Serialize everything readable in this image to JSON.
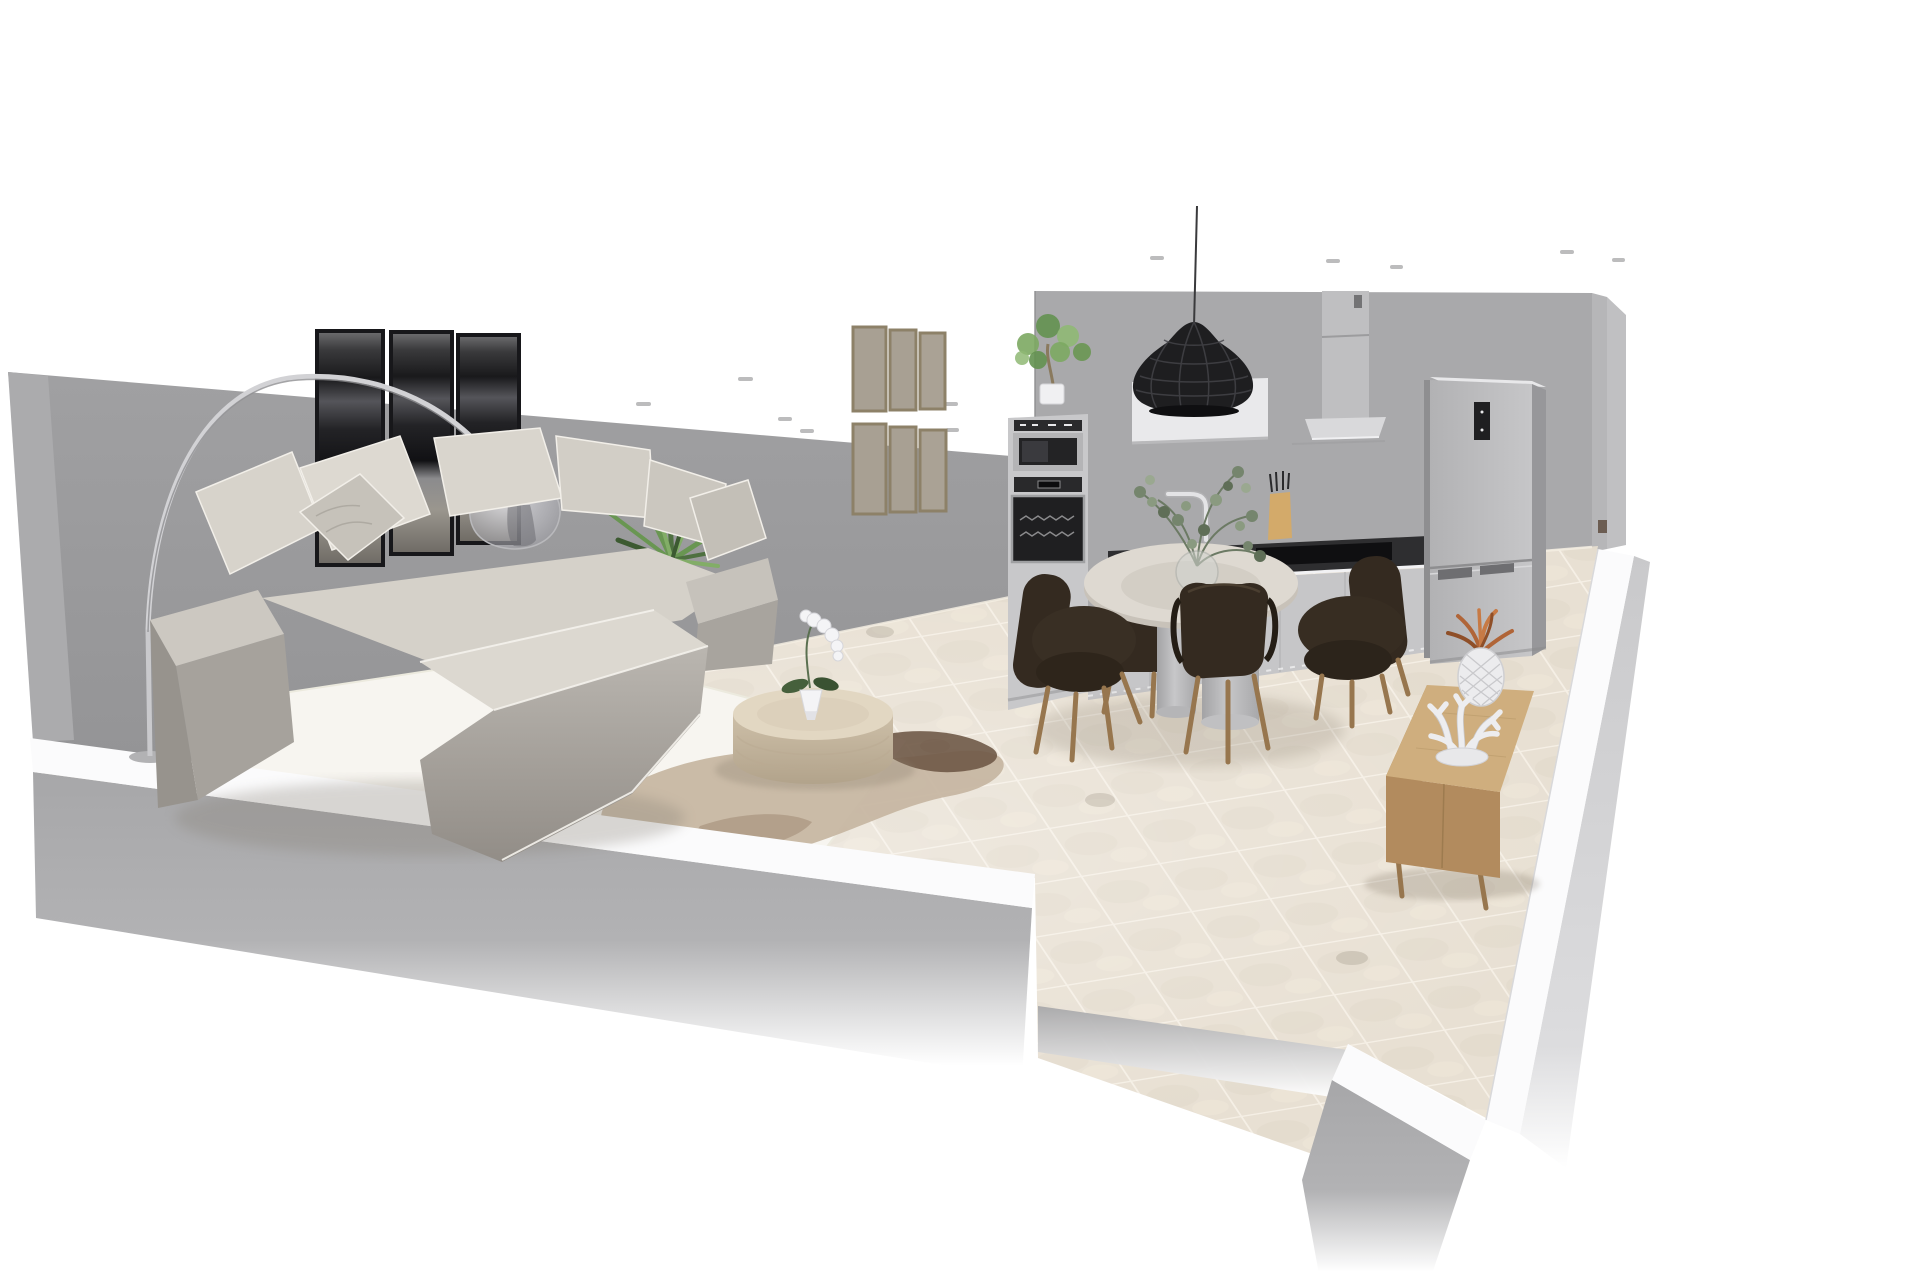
{
  "scene": {
    "label": "3D interior rendering of an open-plan apartment: living room with sectional sofa and arc lamp, kitchen with appliances, round dining table with four chairs, and oak sideboard, shown as a cutaway perspective on a white background",
    "type": "3d-floorplan-render",
    "camera": "elevated three-quarter cutaway view",
    "background": "#ffffff",
    "rooms": [
      "living-room",
      "kitchen",
      "dining-area"
    ]
  },
  "objects": {
    "living_room": [
      "sectional-sofa",
      "throw-pillows",
      "arc-floor-lamp",
      "wall-art-triptych",
      "gallery-wall-frames",
      "yucca-plant",
      "white-fur-rug",
      "cowhide-rug",
      "round-coffee-table",
      "potted-orchid"
    ],
    "kitchen": [
      "oven-column",
      "microwave",
      "oven",
      "base-cabinets",
      "cooktop",
      "knife-block",
      "faucet",
      "wall-cabinet",
      "range-hood",
      "pendant-lamp",
      "fridge-freezer",
      "potted-tree"
    ],
    "dining_area": [
      "round-pedestal-table",
      "dining-chairs",
      "eucalyptus-vase"
    ],
    "decor": [
      "oak-sideboard",
      "pineapple-vase",
      "coral-sculpture"
    ],
    "counts": {
      "dining_chairs": 4,
      "gallery_frames": 6,
      "art_panels": 3,
      "ceiling_spotlights": 13
    }
  },
  "palette": {
    "background": "#ffffff",
    "wall_living": "#9c9c9e",
    "wall_kitchen": "#a9a9ab",
    "wall_west": "#ababad",
    "wall_corner_a": "#b6b6b8",
    "wall_corner_b": "#c0c0c2",
    "wall_top_white": "#fbfbfc",
    "floor_tile": "#e8e0d3",
    "grout": "#f5efe5",
    "rug_white": "#f7f5f0",
    "cowhide": "#c5b5a1",
    "cowhide_dark": "#6f5947",
    "coffee_table_top": "#e2d7c2",
    "sofa_light": "#d5d1c9",
    "sofa_mid": "#b3afa9",
    "art_frame": "#17171a",
    "gallery_frame": "#8d8168",
    "plant_green": "#699652",
    "pendant_black": "#1e1e20",
    "appliance_steel": "#b4b4b6",
    "appliance_glass": "#1f1f21",
    "cabinet_gray": "#c6c6c8",
    "counter_dark": "#2e2e30",
    "fridge_side": "#97979a",
    "chair_brown": "#342a20",
    "chair_leg": "#97764e",
    "table_top": "#ded9d1",
    "pedestal_gray": "#b5b5b7",
    "sideboard_top": "#cfae7e",
    "sideboard_front": "#b28b5e",
    "pineapple_leaf": "#b06538",
    "ceramic_white": "#ececee",
    "knife_block": "#d3aa6a",
    "eucalyptus": "#75856d"
  }
}
